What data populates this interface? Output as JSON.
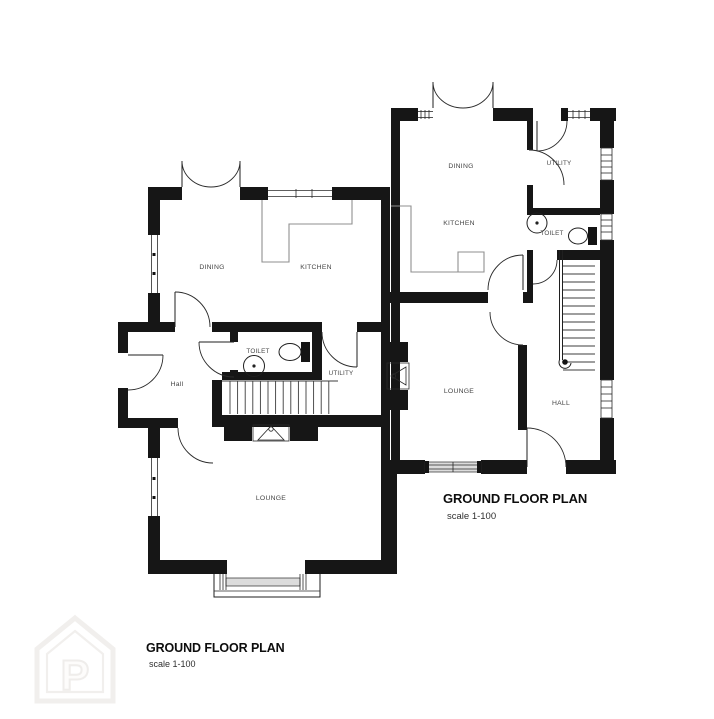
{
  "sheet": {
    "background": "#ffffff"
  },
  "house_left": {
    "rooms": {
      "dining": "DINING",
      "kitchen": "KITCHEN",
      "toilet": "TOILET",
      "utility": "UTILITY",
      "hall": "Hall",
      "lounge": "LOUNGE"
    },
    "title": "GROUND FLOOR PLAN",
    "scale_label": "scale 1-100"
  },
  "house_right": {
    "rooms": {
      "dining": "DINING",
      "kitchen": "KITCHEN",
      "utility": "UTILITY",
      "toilet": "TOILET",
      "lounge": "LOUNGE",
      "hall": "HALL"
    },
    "title": "GROUND FLOOR PLAN",
    "scale_label": "scale 1-100"
  },
  "watermark": {
    "letter": "P"
  },
  "colors": {
    "wall": "#161616",
    "label": "#454545",
    "glazing": "#dcdcdc",
    "counter": "#8f8f8f",
    "watermark": "#f1efed"
  }
}
